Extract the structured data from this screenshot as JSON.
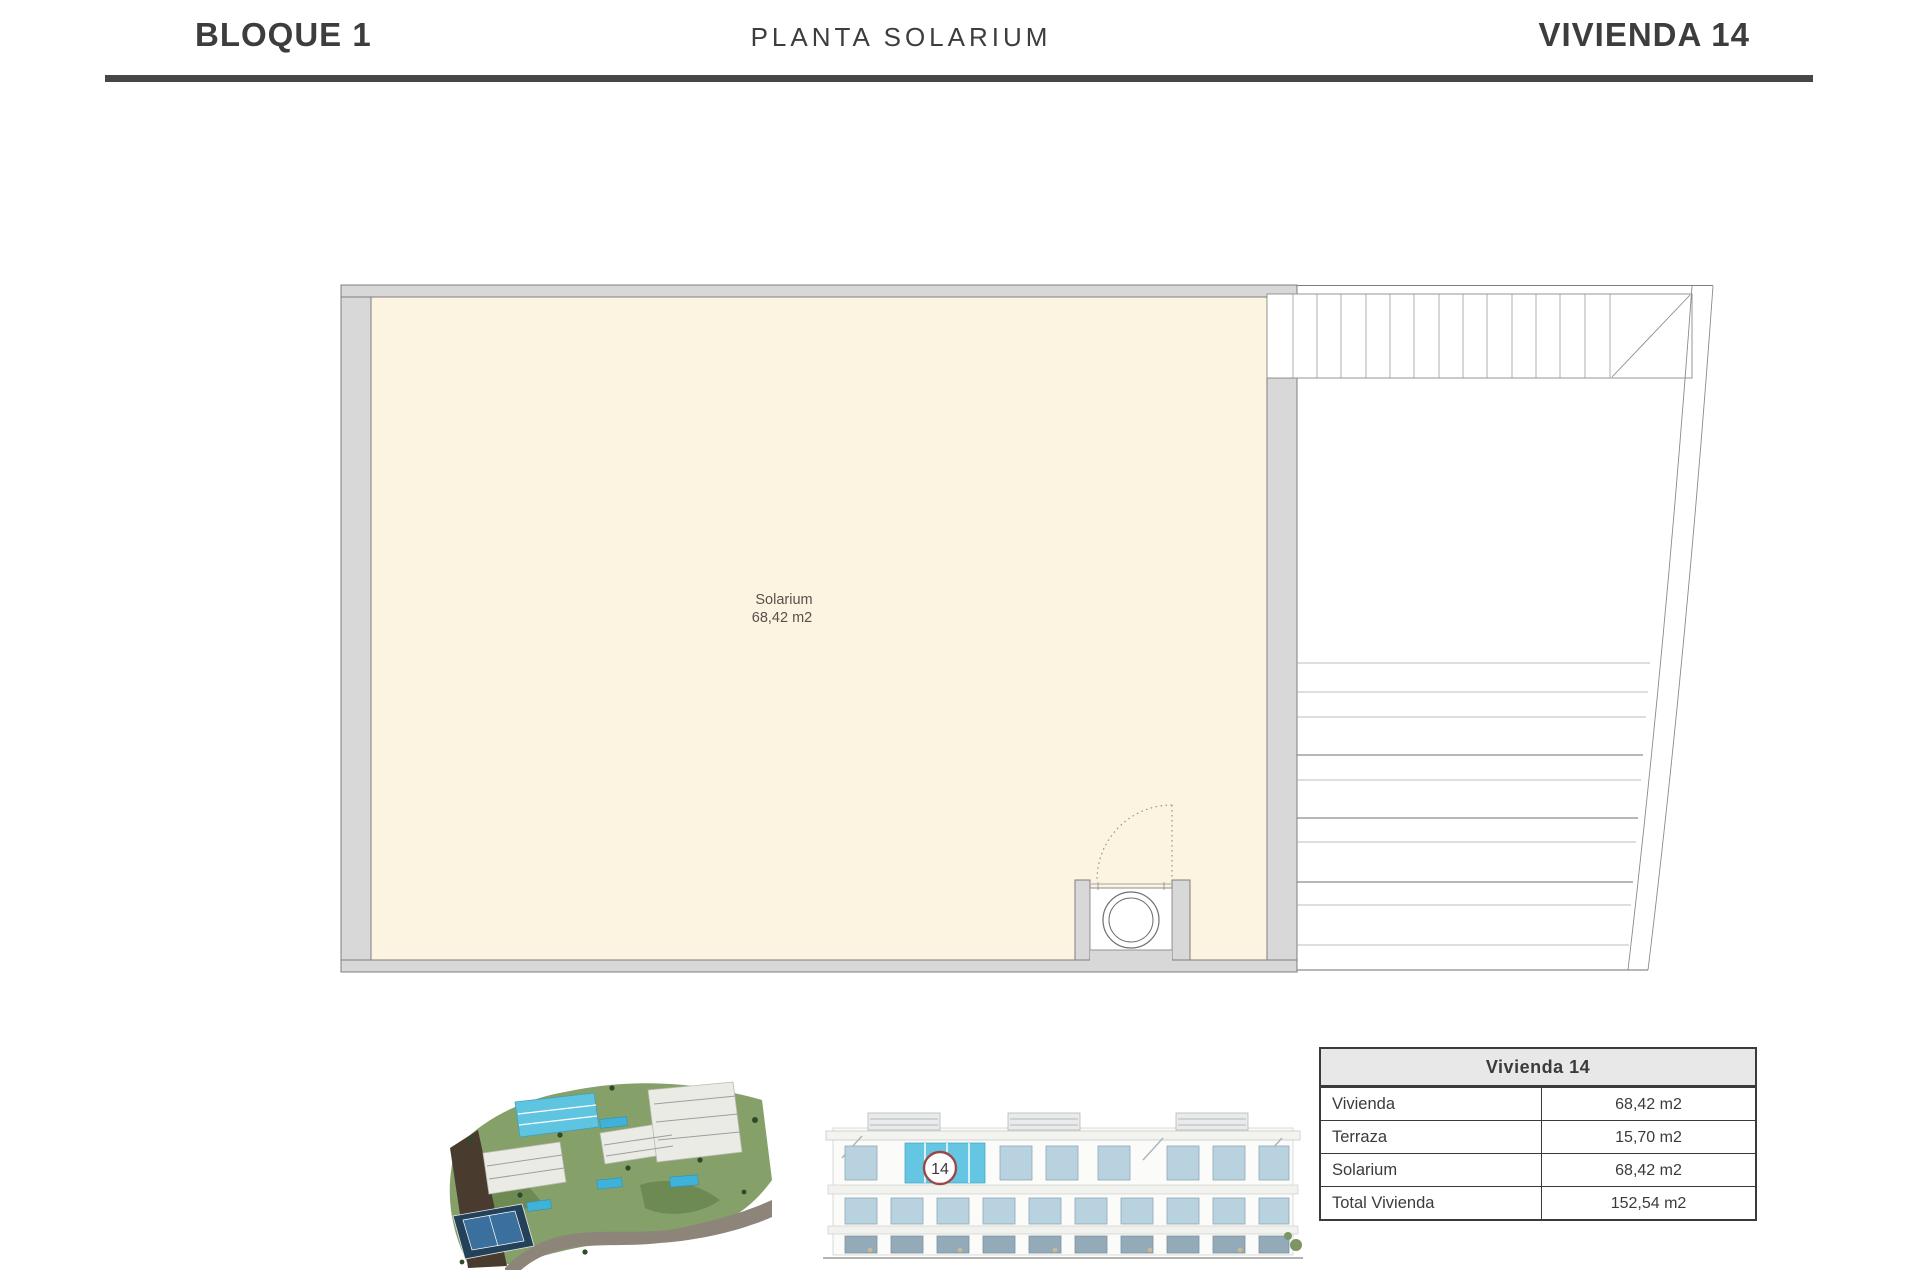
{
  "header": {
    "block": "BLOQUE 1",
    "plan_type": "PLANTA SOLARIUM",
    "unit": "VIVIENDA 14"
  },
  "plan": {
    "room_name": "Solarium",
    "room_area": "68,42 m2"
  },
  "elevation": {
    "badge": "14"
  },
  "table": {
    "title": "Vivienda 14",
    "rows": [
      {
        "label": "Vivienda",
        "value": "68,42 m2"
      },
      {
        "label": "Terraza",
        "value": "15,70 m2"
      },
      {
        "label": "Solarium",
        "value": "68,42 m2"
      },
      {
        "label": "Total Vivienda",
        "value": "152,54 m2"
      }
    ]
  },
  "colors": {
    "room_fill": "#fcf4e1",
    "wall_fill": "#d8d8d8",
    "wall_line": "#7e7e7e",
    "highlight_cyan": "#5ec4e0",
    "badge_ring": "#9c4747",
    "rule": "#474747"
  }
}
